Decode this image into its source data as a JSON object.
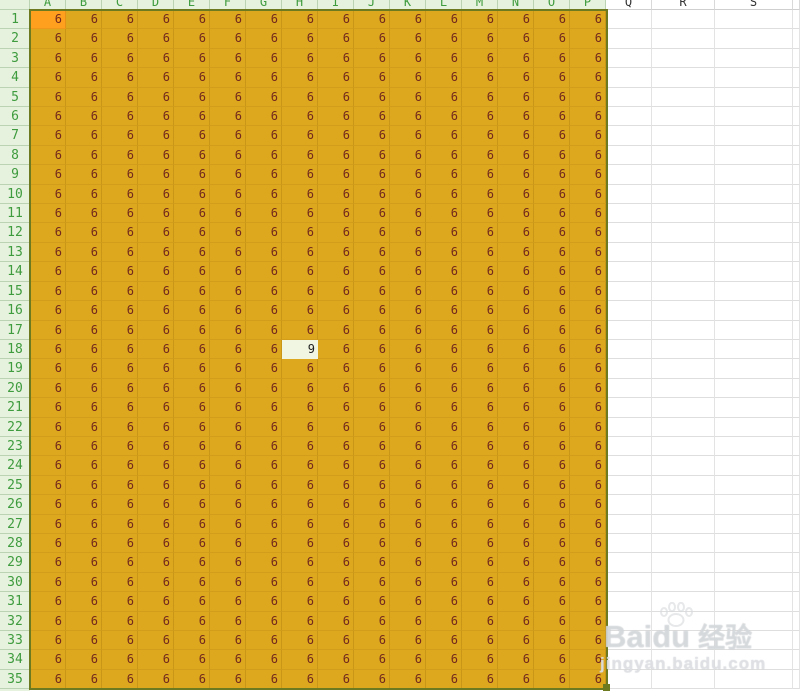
{
  "sheet": {
    "corner_label": "",
    "column_headers": [
      {
        "label": "A",
        "width": 36,
        "highlighted": true
      },
      {
        "label": "B",
        "width": 36,
        "highlighted": true
      },
      {
        "label": "C",
        "width": 36,
        "highlighted": true
      },
      {
        "label": "D",
        "width": 36,
        "highlighted": true
      },
      {
        "label": "E",
        "width": 36,
        "highlighted": true
      },
      {
        "label": "F",
        "width": 36,
        "highlighted": true
      },
      {
        "label": "G",
        "width": 36,
        "highlighted": true
      },
      {
        "label": "H",
        "width": 36,
        "highlighted": true
      },
      {
        "label": "I",
        "width": 36,
        "highlighted": true
      },
      {
        "label": "J",
        "width": 36,
        "highlighted": true
      },
      {
        "label": "K",
        "width": 36,
        "highlighted": true
      },
      {
        "label": "L",
        "width": 36,
        "highlighted": true
      },
      {
        "label": "M",
        "width": 36,
        "highlighted": true
      },
      {
        "label": "N",
        "width": 36,
        "highlighted": true
      },
      {
        "label": "O",
        "width": 36,
        "highlighted": true
      },
      {
        "label": "P",
        "width": 36,
        "highlighted": true
      },
      {
        "label": "Q",
        "width": 46,
        "highlighted": false
      },
      {
        "label": "R",
        "width": 63,
        "highlighted": false
      },
      {
        "label": "S",
        "width": 78,
        "highlighted": false
      }
    ],
    "row_numbers": [
      1,
      2,
      3,
      4,
      5,
      6,
      7,
      8,
      9,
      10,
      11,
      12,
      13,
      14,
      15,
      16,
      17,
      18,
      19,
      20,
      21,
      22,
      23,
      24,
      25,
      26,
      27,
      28,
      29,
      30,
      31,
      32,
      33,
      34,
      35
    ],
    "grid": {
      "rows": 35,
      "filled_columns": 16,
      "fill_value": "6",
      "exception": {
        "row": 18,
        "column_label": "H",
        "value": "9"
      },
      "active_cell": "A1",
      "selected_range": "A1:P35"
    },
    "colors": {
      "cell_fill": "#DDA71E",
      "active_cell_fill": "#FFA01E",
      "digit": "#73291D",
      "exception_fill": "#F0F6E2",
      "exception_digit": "#1F1F1F",
      "header_bg": "#E6F2DD",
      "header_text": "#3E9B3E",
      "header_line": "#BBD3B3",
      "plain_header_text": "#333333",
      "selection_border": "#6D7A1F"
    },
    "watermark": {
      "brand_latin": "Baidu",
      "brand_cjk": "经验",
      "url": "jingyan.baidu.com"
    }
  }
}
